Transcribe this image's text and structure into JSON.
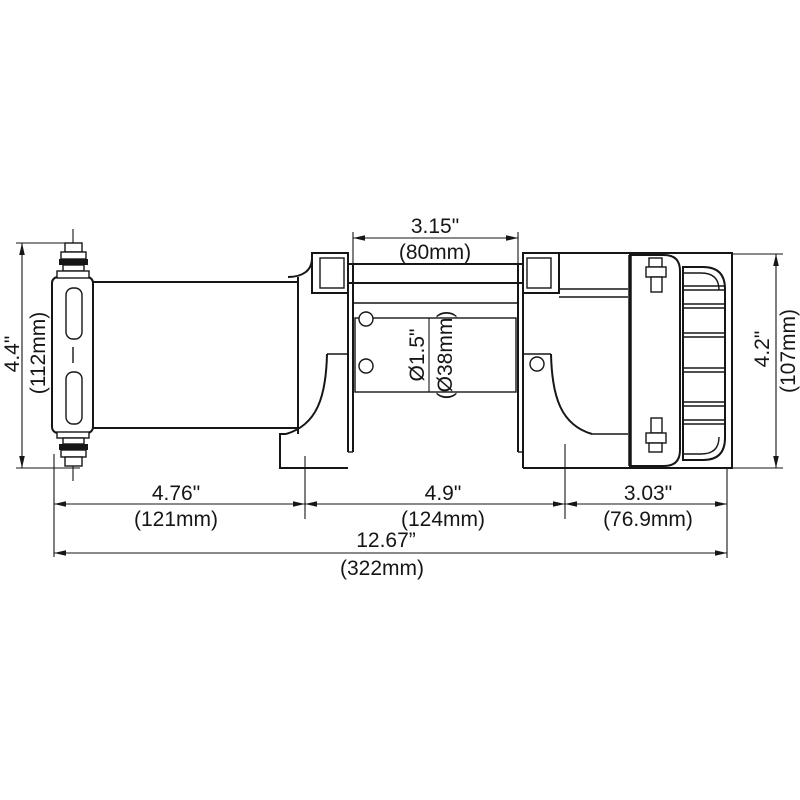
{
  "diagram": {
    "kind": "technical-dimension-drawing",
    "subject_label": "electric winch side elevation",
    "colors": {
      "line": "#161616",
      "background": "#ffffff"
    },
    "dimensions": {
      "drum_length_in": "3.15\"",
      "drum_length_mm": "(80mm)",
      "left_height_in": "4.4\"",
      "left_height_mm": "(112mm)",
      "right_height_in": "4.2\"",
      "right_height_mm": "(107mm)",
      "drum_diameter_in": "Ø1.5\"",
      "drum_diameter_mm": "(Ø38mm)",
      "motor_section_in": "4.76\"",
      "motor_section_mm": "(121mm)",
      "drum_section_in": "4.9\"",
      "drum_section_mm": "(124mm)",
      "gearbox_section_in": "3.03\"",
      "gearbox_section_mm": "(76.9mm)",
      "overall_length_in": "12.67”",
      "overall_length_mm": "(322mm)"
    }
  }
}
